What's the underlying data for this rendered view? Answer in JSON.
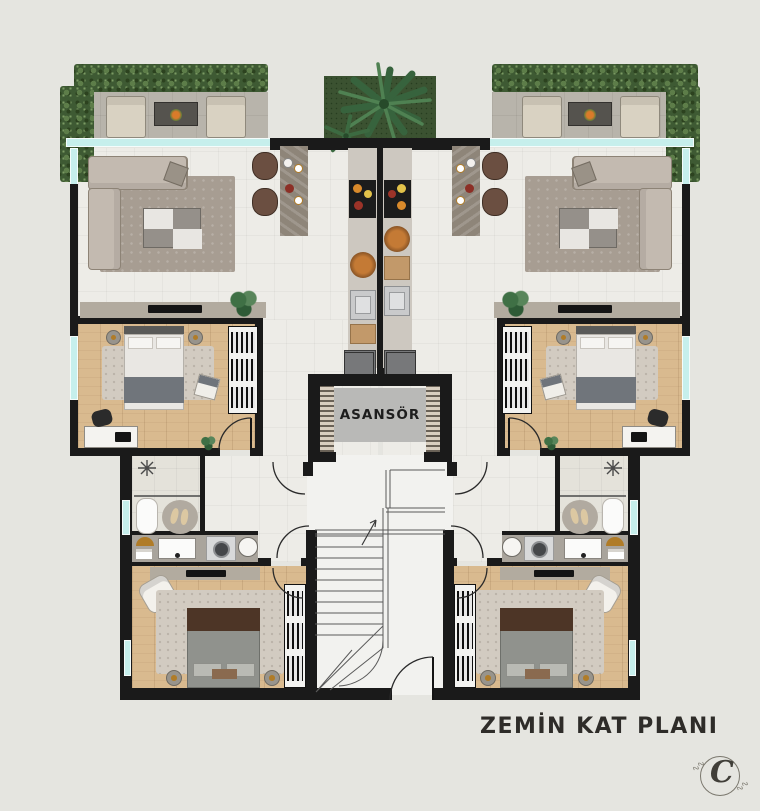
{
  "plan": {
    "title": "ZEMİN KAT PLANI",
    "elevator_label": "ASANSÖR",
    "logo_monogram": "C",
    "logo_squiggle": "∿∿"
  },
  "colors": {
    "bg": "#e5e5e0",
    "wall": "#1a1a1a",
    "glass": "#c6efec",
    "marble": "#edece7",
    "marble2": "#e4e2da",
    "wood": "#d9ba8f",
    "terrace": "#b8b4ab",
    "hedge": "#3e5a33",
    "grass": "#3b5231",
    "rug": "#a79d92",
    "rug2": "#d2cbc1",
    "sofa": "#c3bab0",
    "sofa-line": "#8d8376",
    "counter-dark": "#8e8579",
    "counter": "#cdc8c0",
    "steel": "#c9cacb",
    "stove": "#1c1c1c",
    "elev": "#b9b9b7",
    "hatch": "#b9a98f",
    "bed-white": "#e9e7e3",
    "bed-gray": "#70757b",
    "bed-brown": "#4d3526",
    "bed-gray2": "#90928d",
    "bath": "#a9a49c",
    "white": "#fbfbfa",
    "gold": "#b07c28",
    "title": "#2e2c29",
    "hall": "#f2f2ef",
    "console": "#b2ab9f",
    "panel": "#77787a"
  }
}
